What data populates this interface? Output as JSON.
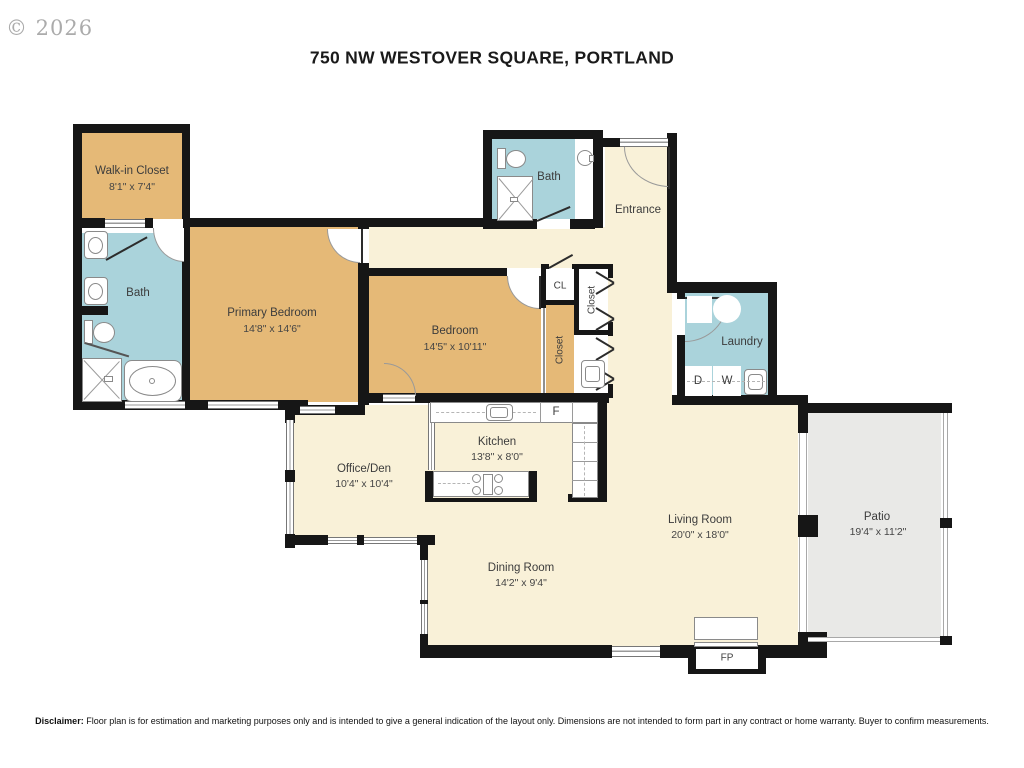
{
  "header": {
    "copyright": "© 2026",
    "title": "750 NW WESTOVER SQUARE, PORTLAND"
  },
  "rooms": {
    "walk_in_closet": {
      "name": "Walk-in Closet",
      "dims": "8'1\" x 7'4\""
    },
    "bath_primary": {
      "name": "Bath"
    },
    "primary_bedroom": {
      "name": "Primary Bedroom",
      "dims": "14'8\" x 14'6\""
    },
    "bedroom": {
      "name": "Bedroom",
      "dims": "14'5\" x 10'11\""
    },
    "bath_hall": {
      "name": "Bath"
    },
    "entrance": {
      "name": "Entrance"
    },
    "closet_cl": {
      "name": "CL"
    },
    "closet_hall": {
      "name": "Closet"
    },
    "closet_bedroom": {
      "name": "Closet"
    },
    "laundry": {
      "name": "Laundry",
      "dryer": "D",
      "washer": "W"
    },
    "kitchen": {
      "name": "Kitchen",
      "dims": "13'8\" x 8'0\"",
      "fridge": "F"
    },
    "office_den": {
      "name": "Office/Den",
      "dims": "10'4\" x 10'4\""
    },
    "living_room": {
      "name": "Living Room",
      "dims": "20'0\" x 18'0\""
    },
    "dining_room": {
      "name": "Dining Room",
      "dims": "14'2\" x 9'4\""
    },
    "patio": {
      "name": "Patio",
      "dims": "19'4\" x 11'2\""
    },
    "fireplace": {
      "name": "FP"
    }
  },
  "footer": {
    "disclaimer_label": "Disclaimer:",
    "disclaimer_text": " Floor plan is for estimation and marketing purposes only and is intended to give a general indication of the layout only. Dimensions are not intended to form part in any contract or home warranty. Buyer to confirm measurements."
  },
  "colors": {
    "wall": "#161616",
    "room_tan": "#e5b977",
    "room_blue": "#aad3db",
    "room_cream": "#f9f1d8",
    "patio_gray": "#e9e9e7"
  }
}
